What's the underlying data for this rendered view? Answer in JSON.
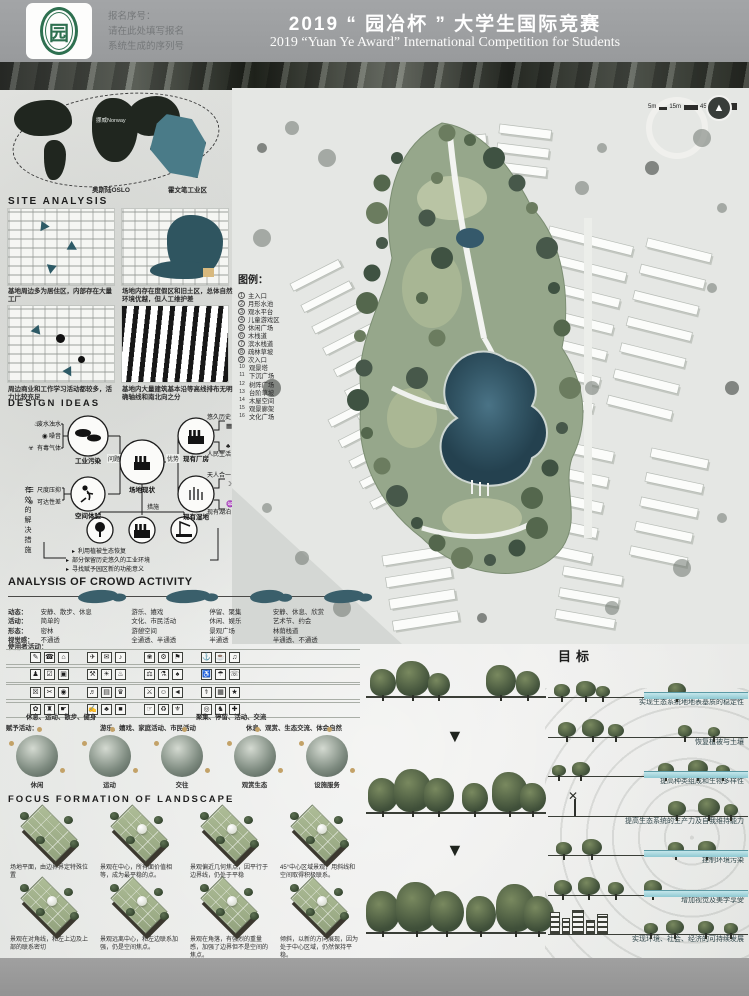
{
  "header": {
    "reg_label": "报名序号：",
    "reg_line2": "请在此处填写报名",
    "reg_line3": "系统生成的序列号",
    "title_zh": "2019 “ 园冶杯 ” 大学生国际竞赛",
    "title_en": "2019 “Yuan Ye Award” International Competition for  Students",
    "logo_char": "园"
  },
  "scalebar": {
    "labels": [
      "5m",
      "15m",
      "45m"
    ],
    "north_glyph": "▲"
  },
  "location_map": {
    "oslo": "奥斯陆OSLO",
    "site": "霍文笔工业区",
    "norway": "挪威Norway"
  },
  "site_analysis": {
    "title": "SITE ANALYSIS",
    "captions": [
      "基地周边多为居住区，内部存在大量工厂",
      "场地内存在度假区和旧土区，总体自然环境优越，但人工维护差",
      "周边商业和工作学习活动都较多，活力比较充足",
      "基地内大量建筑基本沿等高线排布无明确轴线和南北向之分"
    ]
  },
  "legend": {
    "title": "图例：",
    "items": [
      "主入口",
      "月形水池",
      "观水平台",
      "儿童游戏区",
      "休闲广场",
      "木栈道",
      "滨水栈道",
      "疏林草坡",
      "次入口",
      "观景塔",
      "下沉广场",
      "树阵广场",
      "台阶草坡",
      "木屋空间",
      "观景廊架",
      "文化广场"
    ]
  },
  "design_ideas": {
    "title": "DESIGN IDEAS",
    "problem_label": "问题",
    "advantage_label": "优势",
    "center_label": "场地现状",
    "pollution_label": "工业污染",
    "pollution_items": [
      "废水浊水",
      "噪音",
      "有毒气体"
    ],
    "space_label": "空间体验",
    "space_items": [
      "尺度压抑",
      "可达性差"
    ],
    "factory_label": "现有厂房",
    "factory_items": [
      "悠久历史",
      "人民生活"
    ],
    "wetland_label": "现有湿地",
    "wetland_items": [
      "天人合一",
      "现有湖泊"
    ],
    "measures_label": "措施",
    "left_vertical": "有效的解决措施",
    "measures": [
      "利用植被生态恢复",
      "部分保留历史悠久的工业环境",
      "寻找赋予园区新的功能意义"
    ],
    "icons": {
      "waste_water": "♨",
      "noise": "◉",
      "toxic_gas": "☣",
      "scale_oppress": "☰",
      "poor_access": "⊗",
      "history": "▦",
      "people_life": "♣",
      "harmony": "☽",
      "lake": "♒"
    }
  },
  "crowd": {
    "title": "ANALYSIS OF CROWD ACTIVITY",
    "row_labels": [
      "动态：",
      "活动：",
      "形态：",
      "视觉感："
    ],
    "columns": [
      {
        "rows": [
          "安静、散步、休息",
          "简单的",
          "密林",
          "不通透"
        ]
      },
      {
        "rows": [
          "游乐、嬉戏",
          "文化、市民活动",
          "游憩空间",
          "全通透、半通透"
        ]
      },
      {
        "rows": [
          "停留、聚集",
          "休闲、娱乐",
          "景观广场",
          "半通透"
        ]
      },
      {
        "rows": [
          "安静、休息、欣赏",
          "艺术节、约会",
          "林荫栈道",
          "半通透、不通透"
        ]
      }
    ],
    "user_label": "使用者活动：",
    "give_label": "赋予活动：",
    "icon_grid": [
      [
        "✎",
        "☎",
        "⌂",
        "✈",
        "✉",
        "♪",
        "❀",
        "⚙",
        "⚑",
        "⚓",
        "☕",
        "♫"
      ],
      [
        "♟",
        "☑",
        "▣",
        "⚒",
        "☀",
        "♨",
        "⚖",
        "⚗",
        "♠",
        "♿",
        "☂",
        "☏"
      ],
      [
        "☒",
        "✂",
        "◉",
        "♬",
        "▤",
        "♛",
        "⚔",
        "☺",
        "◄",
        "⚕",
        "▦",
        "★"
      ],
      [
        "✿",
        "♜",
        "☛",
        "✍",
        "♣",
        "■",
        "☞",
        "♻",
        "⚜",
        "◎",
        "♞",
        "✚"
      ]
    ],
    "activity_captions": [
      "休息、运动、散步、健身",
      "游乐、嬉戏、家庭活动、市民活动",
      "聚集、停留、活动、交流",
      "休息、观赏、生态交流、体会自然"
    ],
    "photo_captions": [
      "休闲",
      "运动",
      "交往",
      "观赏生态",
      "设施服务"
    ]
  },
  "focus": {
    "title": "FOCUS FORMATION OF LANDSCAPE",
    "captions_row1": [
      "场地平面，由边界界定特殊位置",
      "景观在中心，所有面价值相等，成为最平稳的点。",
      "景观偏近几何焦点，因平行于边界线，仍处于平稳",
      "45°中心区域景观，用斜线和空间取得积极联系。"
    ],
    "captions_row2": [
      "景观在对角线，和左上边及上部的联系密切",
      "景观远离中心，和左边联系加强，仍是空间焦点。",
      "景观在角落，有强烈的重量感，加强了边界但不是空间的焦点。",
      "倾斜，以新的方向展现，因为处于中心区域，仍然保持平稳。"
    ]
  },
  "goals": {
    "title": "目标",
    "items": [
      {
        "text": "实现生态系统地地表基质的稳定性",
        "scene": "water"
      },
      {
        "text": "恢复植被与土壤",
        "scene": "trees"
      },
      {
        "text": "提高种类组成和生物多样性",
        "scene": "trees-water"
      },
      {
        "text": "提高生态系统的生产力及自我维持能力",
        "scene": "windmill"
      },
      {
        "text": "控制环境污染",
        "scene": "trees-water"
      },
      {
        "text": "增加视觉及美学享受",
        "scene": "trees-water"
      },
      {
        "text": "实现环境、社会、经济的可持续发展",
        "scene": "city"
      }
    ]
  }
}
